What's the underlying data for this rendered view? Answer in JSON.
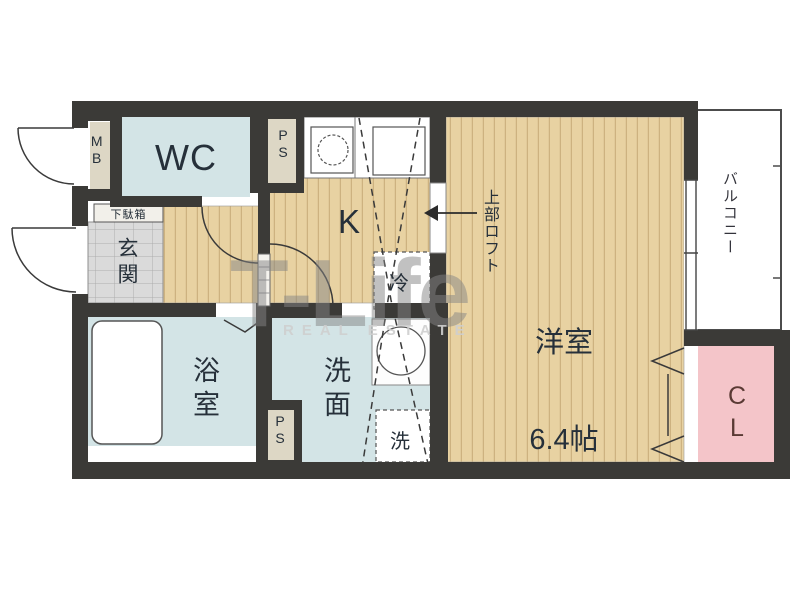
{
  "floorplan": {
    "watermark": {
      "brand": "T-Life",
      "subtitle": "REAL ESTATE"
    },
    "rooms": {
      "wc": {
        "label": "WC"
      },
      "meter_box": {
        "label": "MB"
      },
      "pipe_space_top": {
        "label": "PS"
      },
      "pipe_space_bottom": {
        "label": "PS"
      },
      "shoe_cabinet": {
        "label": "下駄箱"
      },
      "entrance": {
        "label": "玄関"
      },
      "kitchen": {
        "label": "K"
      },
      "bathroom": {
        "label": "浴室"
      },
      "washroom": {
        "label": "洗面"
      },
      "washer_space": {
        "label": "洗"
      },
      "refrigerator_space": {
        "label": "冷"
      },
      "western_room": {
        "label": "洋室",
        "size": "6.4帖"
      },
      "balcony": {
        "label": "バルコニー"
      },
      "closet": {
        "label": "CL"
      }
    },
    "annotations": {
      "upper_loft": "上部ロフト"
    },
    "colors": {
      "wall": "#3b3a37",
      "wood_floor": "#e8d2a2",
      "wood_stripe": "#cdb280",
      "wet_area_blue": "#d3e4e6",
      "closet_pink": "#f4c5c9",
      "service_beige": "#ddd7c5",
      "entrance_tile": "#dadada",
      "watermark_gray": "#858585"
    }
  }
}
